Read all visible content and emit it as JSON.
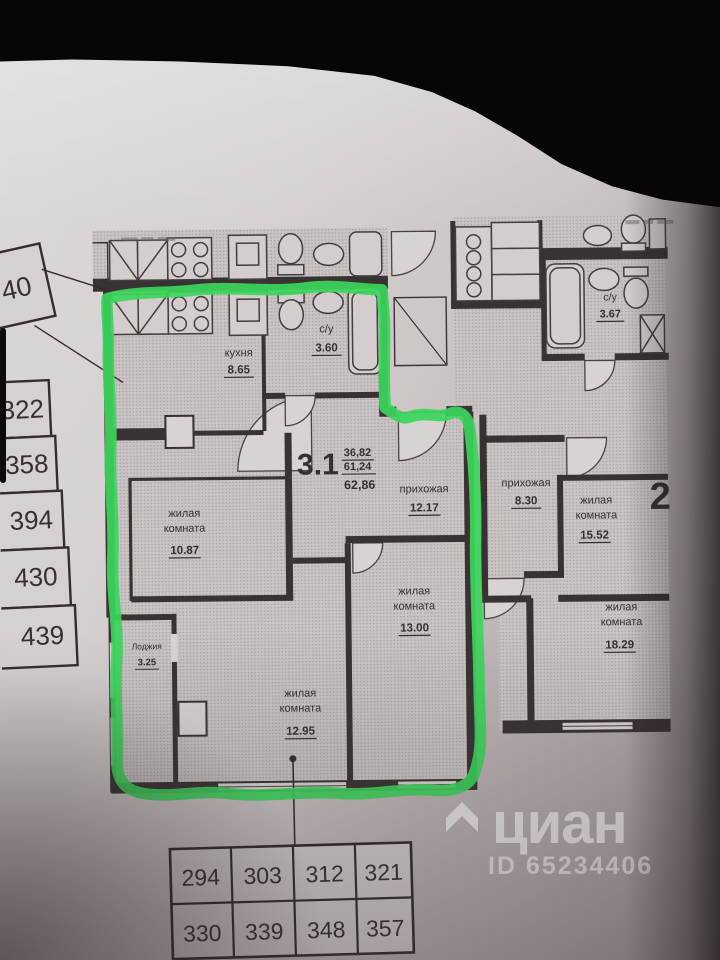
{
  "watermark": {
    "brand": "циан",
    "id_label": "ID 65234406"
  },
  "left_column": {
    "top_box": "40",
    "cells": [
      "322",
      "358",
      "394",
      "430",
      "439"
    ]
  },
  "bottom_table": {
    "rows": [
      [
        "294",
        "303",
        "312",
        "321"
      ],
      [
        "330",
        "339",
        "348",
        "357"
      ]
    ]
  },
  "apt_main": {
    "number": "3.1",
    "area_stack": {
      "living": "36,82",
      "total": "61,24",
      "full": "62,86"
    },
    "kitchen": {
      "name": "кухня",
      "area": "8.65"
    },
    "bath": {
      "name": "с/у",
      "area": "3.60"
    },
    "hall": {
      "name": "прихожая",
      "area": "12.17"
    },
    "room1": {
      "line1": "жилая",
      "line2": "комната",
      "area": "10.87"
    },
    "room2": {
      "line1": "жилая",
      "line2": "комната",
      "area": "13.00"
    },
    "room3": {
      "line1": "жилая",
      "line2": "комната",
      "area": "12.95"
    },
    "loggia": {
      "name": "Лоджия",
      "area": "3.25"
    }
  },
  "apt_right": {
    "number": "2",
    "bath": {
      "name": "с/у",
      "area": "3.67"
    },
    "hall": {
      "name": "прихожая",
      "area": "8.30"
    },
    "room1": {
      "line1": "жилая",
      "line2": "комната",
      "area": "15.52"
    },
    "room2": {
      "line1": "жилая",
      "line2": "комната",
      "area": "18.29"
    }
  },
  "highlight_color": "#3bd65b"
}
